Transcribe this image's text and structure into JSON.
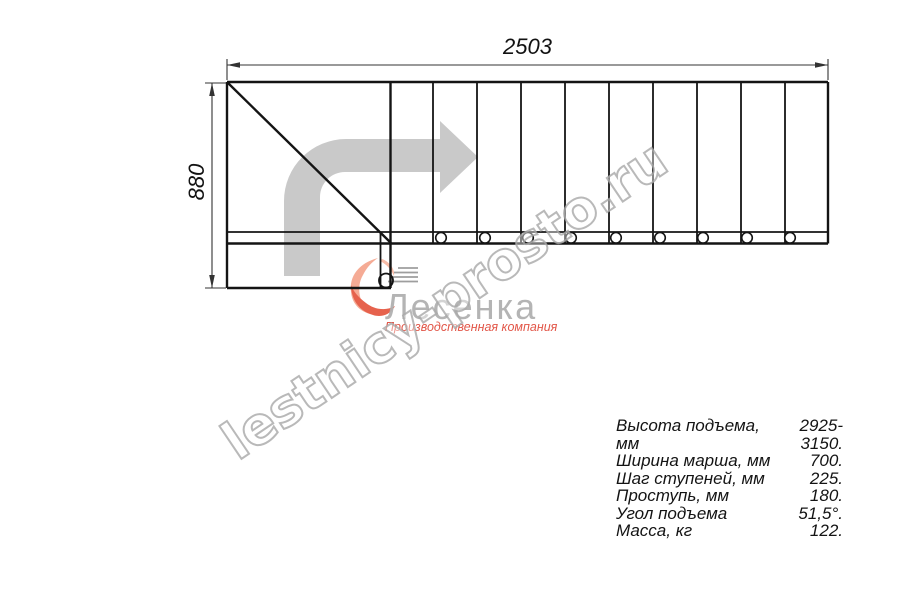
{
  "drawing": {
    "width_label": "2503",
    "height_label": "880"
  },
  "watermark": {
    "text": "lestnicy-prosto.ru"
  },
  "logo": {
    "name": "Лесенка",
    "tagline": "Производственная компания"
  },
  "specs": {
    "rows": [
      {
        "label": "Высота подъема, мм",
        "value": "2925-3150."
      },
      {
        "label": "Ширина марша, мм",
        "value": "700."
      },
      {
        "label": "Шаг ступеней, мм",
        "value": "225."
      },
      {
        "label": "Проступь, мм",
        "value": "180."
      },
      {
        "label": "Угол подъема",
        "value": "51,5°."
      },
      {
        "label": "Масса, кг",
        "value": "122."
      }
    ]
  },
  "colors": {
    "line": "#141414",
    "dimension": "#333333",
    "direction_arrow": "#c9c9c9",
    "watermark_outline": "#a8a8a8",
    "logo_gray": "#b0b0b0",
    "logo_red": "#e6624d",
    "logo_salmon": "#f5ab95"
  }
}
